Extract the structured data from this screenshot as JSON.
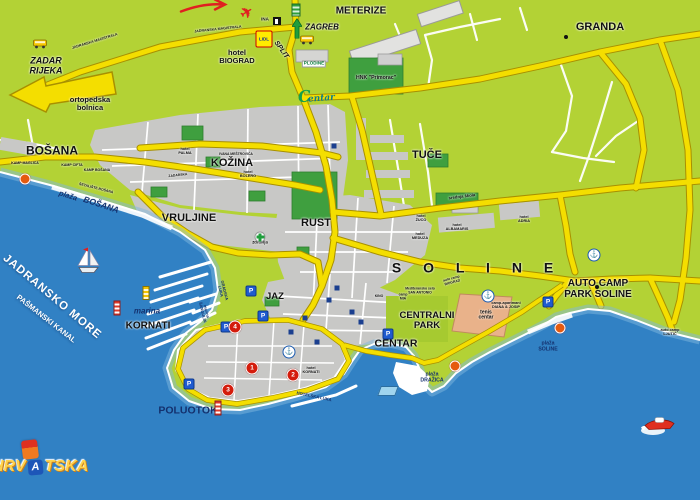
{
  "colors": {
    "land": "#b3d235",
    "sea": "#3181c4",
    "shallow": "#7fb8de",
    "road": "#f4de00",
    "road_casing": "#a89000",
    "urban": "#c8c8c6",
    "park": "#3f9f3f",
    "tennis": "#e9b28a",
    "poi_marker": "#d41c0c",
    "sea_label": "#ffffff",
    "navy_label": "#14316e"
  },
  "logo": {
    "part1": "HRV",
    "letter_a": "A",
    "part2": "TSKA"
  },
  "centar_logo": {
    "c1": "C",
    "c2": "entar"
  },
  "map": {
    "labels": [
      {
        "n": "meterize",
        "t": "METERIZE",
        "x": 361,
        "y": 12,
        "s": 10
      },
      {
        "n": "granda",
        "t": "GRANDA",
        "x": 600,
        "y": 28,
        "s": 11
      },
      {
        "n": "zagreb",
        "t": "ZAGREB",
        "x": 322,
        "y": 28,
        "s": 8,
        "i": 1
      },
      {
        "n": "split",
        "t": "SPLIT",
        "x": 281,
        "y": 50,
        "s": 7,
        "i": 1,
        "r": 55
      },
      {
        "n": "zadar-rijeka",
        "t": "ZADAR\nRIJEKA",
        "x": 46,
        "y": 66,
        "s": 9,
        "i": 1
      },
      {
        "n": "magistrala-west",
        "t": "JADRANSKA MAGISTRALA",
        "x": 95,
        "y": 42,
        "s": 3.6,
        "r": -17
      },
      {
        "n": "magistrala-center",
        "t": "JADRANSKA MAGISTRALA",
        "x": 218,
        "y": 30,
        "s": 3.6,
        "r": -6
      },
      {
        "n": "hotel-biograd",
        "t": "hotel\nBIOGRAD",
        "x": 237,
        "y": 57,
        "s": 7.5
      },
      {
        "n": "ina",
        "t": "INA",
        "x": 265,
        "y": 20,
        "s": 4.5
      },
      {
        "n": "plodine",
        "t": "PLODINE",
        "x": 314,
        "y": 64,
        "s": 4.6,
        "c": "p"
      },
      {
        "n": "hnk-primorac",
        "t": "HNK \"Primorac\"",
        "x": 376,
        "y": 79,
        "s": 5.2
      },
      {
        "n": "ortopedska-bolnica",
        "t": "ortopedska\nbolnica",
        "x": 90,
        "y": 104,
        "s": 7.5
      },
      {
        "n": "bosana",
        "t": "BOŠANA",
        "x": 52,
        "y": 151,
        "s": 12
      },
      {
        "n": "kamp-maglica",
        "t": "KAMP MAGLICA",
        "x": 25,
        "y": 164,
        "s": 3.5
      },
      {
        "n": "kamp-cifta",
        "t": "KAMP CIFTA",
        "x": 72,
        "y": 166,
        "s": 3.5
      },
      {
        "n": "kamp-bosana",
        "t": "KAMP BOŠANA",
        "x": 97,
        "y": 171,
        "s": 3.5
      },
      {
        "n": "setaliste-bosana",
        "t": "ŠETALIŠTE BOŠANA",
        "x": 96,
        "y": 189,
        "s": 3.5,
        "r": 14
      },
      {
        "n": "plaza-bosana-1",
        "t": "plaža",
        "x": 68,
        "y": 196,
        "s": 7.5,
        "i": 1,
        "c": "n",
        "r": 18
      },
      {
        "n": "plaza-bosana-2",
        "t": "BOŠANA",
        "x": 101,
        "y": 205,
        "s": 8.5,
        "i": 1,
        "c": "n",
        "r": 18
      },
      {
        "n": "kozina",
        "t": "KOŽINA",
        "x": 232,
        "y": 164,
        "s": 11
      },
      {
        "n": "hotel-palma",
        "t": "hotel\nPALMA",
        "x": 185,
        "y": 151,
        "s": 3.8
      },
      {
        "n": "hotel-bolero",
        "t": "hotel\nBOLERO",
        "x": 248,
        "y": 174,
        "s": 3.8
      },
      {
        "n": "ivana-mestrovica",
        "t": "IVANA MEŠTROVIĆA",
        "x": 236,
        "y": 155,
        "s": 3.4
      },
      {
        "n": "zadarska",
        "t": "ZADARSKA",
        "x": 178,
        "y": 176,
        "s": 3.4,
        "r": -6
      },
      {
        "n": "vruljine",
        "t": "VRULJINE",
        "x": 189,
        "y": 219,
        "s": 11
      },
      {
        "n": "rust",
        "t": "RUST",
        "x": 316,
        "y": 224,
        "s": 11
      },
      {
        "n": "tuce",
        "t": "TUČE",
        "x": 427,
        "y": 156,
        "s": 11
      },
      {
        "n": "dom-zdravlja",
        "t": "dom\nzdravlja",
        "x": 260,
        "y": 240,
        "s": 4.2
      },
      {
        "n": "soline",
        "t": "S O L I N E",
        "x": 477,
        "y": 268,
        "s": 14,
        "ls": 9
      },
      {
        "n": "auto-camp-park-soline",
        "t": "AUTO CAMP\nPARK SOLINE",
        "x": 598,
        "y": 290,
        "s": 10
      },
      {
        "n": "centralni-park",
        "t": "CENTRALNI\nPARK",
        "x": 427,
        "y": 321,
        "s": 9.5
      },
      {
        "n": "tenis-centar",
        "t": "tenis\ncentar",
        "x": 486,
        "y": 316,
        "s": 5
      },
      {
        "n": "centar",
        "t": "CENTAR",
        "x": 396,
        "y": 344,
        "s": 10.5
      },
      {
        "n": "jaz",
        "t": "JAZ",
        "x": 275,
        "y": 297,
        "s": 9.5
      },
      {
        "n": "gradska-luka",
        "t": "GRADSKA\nLUKA",
        "x": 222,
        "y": 291,
        "s": 4,
        "c": "n",
        "r": 76
      },
      {
        "n": "marina-sangulin",
        "t": "marina\nŠANGULIN",
        "x": 204,
        "y": 312,
        "s": 4,
        "c": "n",
        "r": 76
      },
      {
        "n": "marina-kornati-1",
        "t": "marina",
        "x": 147,
        "y": 312,
        "s": 8,
        "i": 1,
        "c": "n"
      },
      {
        "n": "marina-kornati-2",
        "t": "KORNATI",
        "x": 148,
        "y": 327,
        "s": 10
      },
      {
        "n": "jadransko-more",
        "t": "JADRANSKO MORE",
        "x": 52,
        "y": 297,
        "s": 11.5,
        "c": "w",
        "r": 40,
        "ls": 1
      },
      {
        "n": "pasmanski-kanal",
        "t": "PAŠMANSKI KANAL",
        "x": 46,
        "y": 319,
        "s": 7.5,
        "c": "w",
        "r": 38
      },
      {
        "n": "poluotok",
        "t": "POLUOTOK",
        "x": 188,
        "y": 411,
        "s": 10.5,
        "c": "n"
      },
      {
        "n": "hotelska-luka",
        "t": "HOTELSKA LUKA",
        "x": 314,
        "y": 397,
        "s": 4.2,
        "c": "n",
        "r": 12
      },
      {
        "n": "hotel-kornati",
        "t": "hotel\nKORNATI",
        "x": 311,
        "y": 370,
        "s": 3.8
      },
      {
        "n": "plaza-soline",
        "t": "plaža\nSOLINE",
        "x": 548,
        "y": 347,
        "s": 5.2,
        "c": "n"
      },
      {
        "n": "plaza-drazica",
        "t": "plaža\nDRAŽICA",
        "x": 432,
        "y": 378,
        "s": 5.2,
        "c": "n"
      },
      {
        "n": "auto-camp-ljutic",
        "t": "auto camp\nLJUTIĆ",
        "x": 670,
        "y": 332,
        "s": 3.8
      },
      {
        "n": "san-antonio",
        "t": "Mediteransko selo\nSAN ANTONIO",
        "x": 420,
        "y": 291,
        "s": 3.4
      },
      {
        "n": "auto-camp-biograd",
        "t": "auto camp\nBIOGRAD",
        "x": 452,
        "y": 281,
        "s": 3.4,
        "r": -15
      },
      {
        "n": "camp-mia",
        "t": "camp\nMIA",
        "x": 403,
        "y": 297,
        "s": 3.4
      },
      {
        "n": "diana-josip",
        "t": "camp-apartmani\nDIANA & JOSIP",
        "x": 506,
        "y": 305,
        "s": 3.8
      },
      {
        "n": "hotel-adria",
        "t": "hotel\nADRIA",
        "x": 524,
        "y": 219,
        "s": 3.8
      },
      {
        "n": "hotel-albamaris",
        "t": "hotel\nALBAMARIS",
        "x": 457,
        "y": 227,
        "s": 3.8
      },
      {
        "n": "hotel-meduza",
        "t": "hotel\nMEDUZA",
        "x": 420,
        "y": 236,
        "s": 3.8
      },
      {
        "n": "hotel-zuco",
        "t": "hotel\nŽUCO",
        "x": 421,
        "y": 218,
        "s": 3.8
      },
      {
        "n": "srednja-skola",
        "t": "srednja škola",
        "x": 462,
        "y": 197,
        "s": 4.2,
        "r": -7
      },
      {
        "n": "kino",
        "t": "KINO",
        "x": 379,
        "y": 297,
        "s": 3.4
      }
    ],
    "icons": [
      {
        "t": "hand-arrow",
        "x": 205,
        "y": 9
      },
      {
        "t": "plane",
        "g": "✈",
        "x": 247,
        "y": 13
      },
      {
        "t": "bus",
        "x": 40,
        "y": 45
      },
      {
        "t": "bus",
        "x": 307,
        "y": 41
      },
      {
        "t": "bus-station",
        "x": 296,
        "y": 10
      },
      {
        "t": "fuel",
        "x": 277,
        "y": 21
      },
      {
        "t": "arrow-up",
        "x": 297,
        "y": 31
      },
      {
        "t": "lidl",
        "g": "LIDL",
        "x": 264,
        "y": 39
      },
      {
        "t": "medical-cross",
        "x": 260,
        "y": 229
      },
      {
        "t": "pool",
        "x": 388,
        "y": 391
      },
      {
        "t": "anchor-badge",
        "g": "⚓",
        "x": 488,
        "y": 296
      },
      {
        "t": "anchor-badge",
        "g": "⚓",
        "x": 594,
        "y": 255
      },
      {
        "t": "anchor-badge",
        "g": "⚓",
        "x": 289,
        "y": 352
      },
      {
        "t": "lighthouse",
        "x": 117,
        "y": 308
      },
      {
        "t": "lighthouse",
        "x": 218,
        "y": 408
      },
      {
        "t": "lighthouse-yellow",
        "x": 146,
        "y": 293
      },
      {
        "t": "sailboat",
        "x": 88,
        "y": 263
      },
      {
        "t": "speedboat",
        "x": 658,
        "y": 426
      },
      {
        "t": "beach-marker",
        "x": 25,
        "y": 179
      },
      {
        "t": "beach-marker",
        "x": 455,
        "y": 366
      },
      {
        "t": "beach-marker",
        "x": 560,
        "y": 328
      },
      {
        "t": "parking",
        "g": "P",
        "x": 251,
        "y": 291
      },
      {
        "t": "parking",
        "g": "P",
        "x": 226,
        "y": 327
      },
      {
        "t": "parking",
        "g": "P",
        "x": 388,
        "y": 334
      },
      {
        "t": "parking",
        "g": "P",
        "x": 548,
        "y": 302
      },
      {
        "t": "parking",
        "g": "P",
        "x": 189,
        "y": 384
      },
      {
        "t": "parking",
        "g": "P",
        "x": 263,
        "y": 316
      },
      {
        "t": "poi-marker",
        "g": "1",
        "x": 252,
        "y": 368
      },
      {
        "t": "poi-marker",
        "g": "2",
        "x": 293,
        "y": 375
      },
      {
        "t": "poi-marker",
        "g": "3",
        "x": 228,
        "y": 390
      },
      {
        "t": "poi-marker",
        "g": "4",
        "x": 235,
        "y": 327
      },
      {
        "t": "town-dot",
        "x": 597,
        "y": 287
      },
      {
        "t": "town-dot",
        "x": 566,
        "y": 37
      },
      {
        "t": "poi-square",
        "x": 305,
        "y": 318
      },
      {
        "t": "poi-square",
        "x": 329,
        "y": 300
      },
      {
        "t": "poi-square",
        "x": 352,
        "y": 312
      },
      {
        "t": "poi-square",
        "x": 291,
        "y": 332
      },
      {
        "t": "poi-square",
        "x": 317,
        "y": 342
      },
      {
        "t": "poi-square",
        "x": 361,
        "y": 322
      },
      {
        "t": "poi-square",
        "x": 337,
        "y": 288
      },
      {
        "t": "poi-square",
        "x": 334,
        "y": 146
      }
    ]
  }
}
